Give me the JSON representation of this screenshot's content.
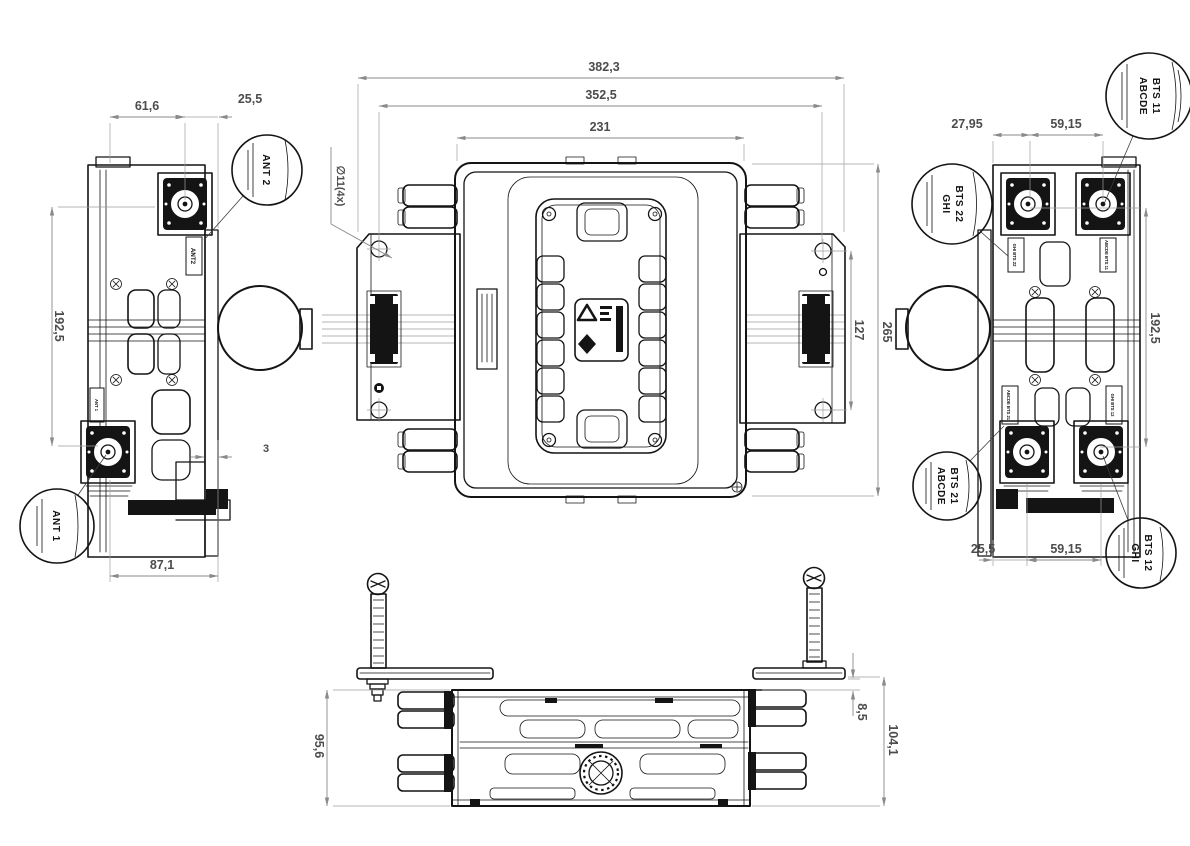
{
  "drawing_type": "engineering-dimension-drawing",
  "dimensions": {
    "left_view": {
      "top_left_width": "61,6",
      "top_right_width": "25,5",
      "height": "192,5",
      "plate_gap": "3",
      "bottom_width": "87,1"
    },
    "top_view": {
      "overall_width": "382,3",
      "mount_hole_pitch_horizontal": "352,5",
      "body_width": "231",
      "mount_hole_pitch_vertical": "127",
      "overall_depth": "265",
      "hole_callout": "∅11(4x)"
    },
    "right_view": {
      "top_left_offset": "27,95",
      "top_connector_pitch": "59,15",
      "height": "192,5",
      "bottom_left_offset": "25,5",
      "bottom_connector_pitch": "59,15"
    },
    "bottom_view": {
      "body_height": "95,6",
      "bracket_standoff": "8,5",
      "overall_height": "104,1"
    }
  },
  "balloons": {
    "ant2": {
      "label": "ANT 2"
    },
    "ant1": {
      "label": "ANT 1"
    },
    "bts11": {
      "line1": "ABCDE",
      "line2": "BTS 11"
    },
    "bts22": {
      "line1": "GHI",
      "line2": "BTS 22"
    },
    "bts21": {
      "line1": "ABCDE",
      "line2": "BTS 21"
    },
    "bts12": {
      "line1": "GHI",
      "line2": "BTS 12"
    }
  },
  "part_tags": {
    "ant2": "ANT2",
    "ant1": "ANT 1",
    "bts22": "GHI BTS 22",
    "bts11": "ABCDE BTS 11",
    "bts21": "ABCDE BTS 21",
    "bts12": "GHI BTS 12"
  },
  "center_label_icons": [
    "recycle-icon",
    "diamond-icon"
  ]
}
